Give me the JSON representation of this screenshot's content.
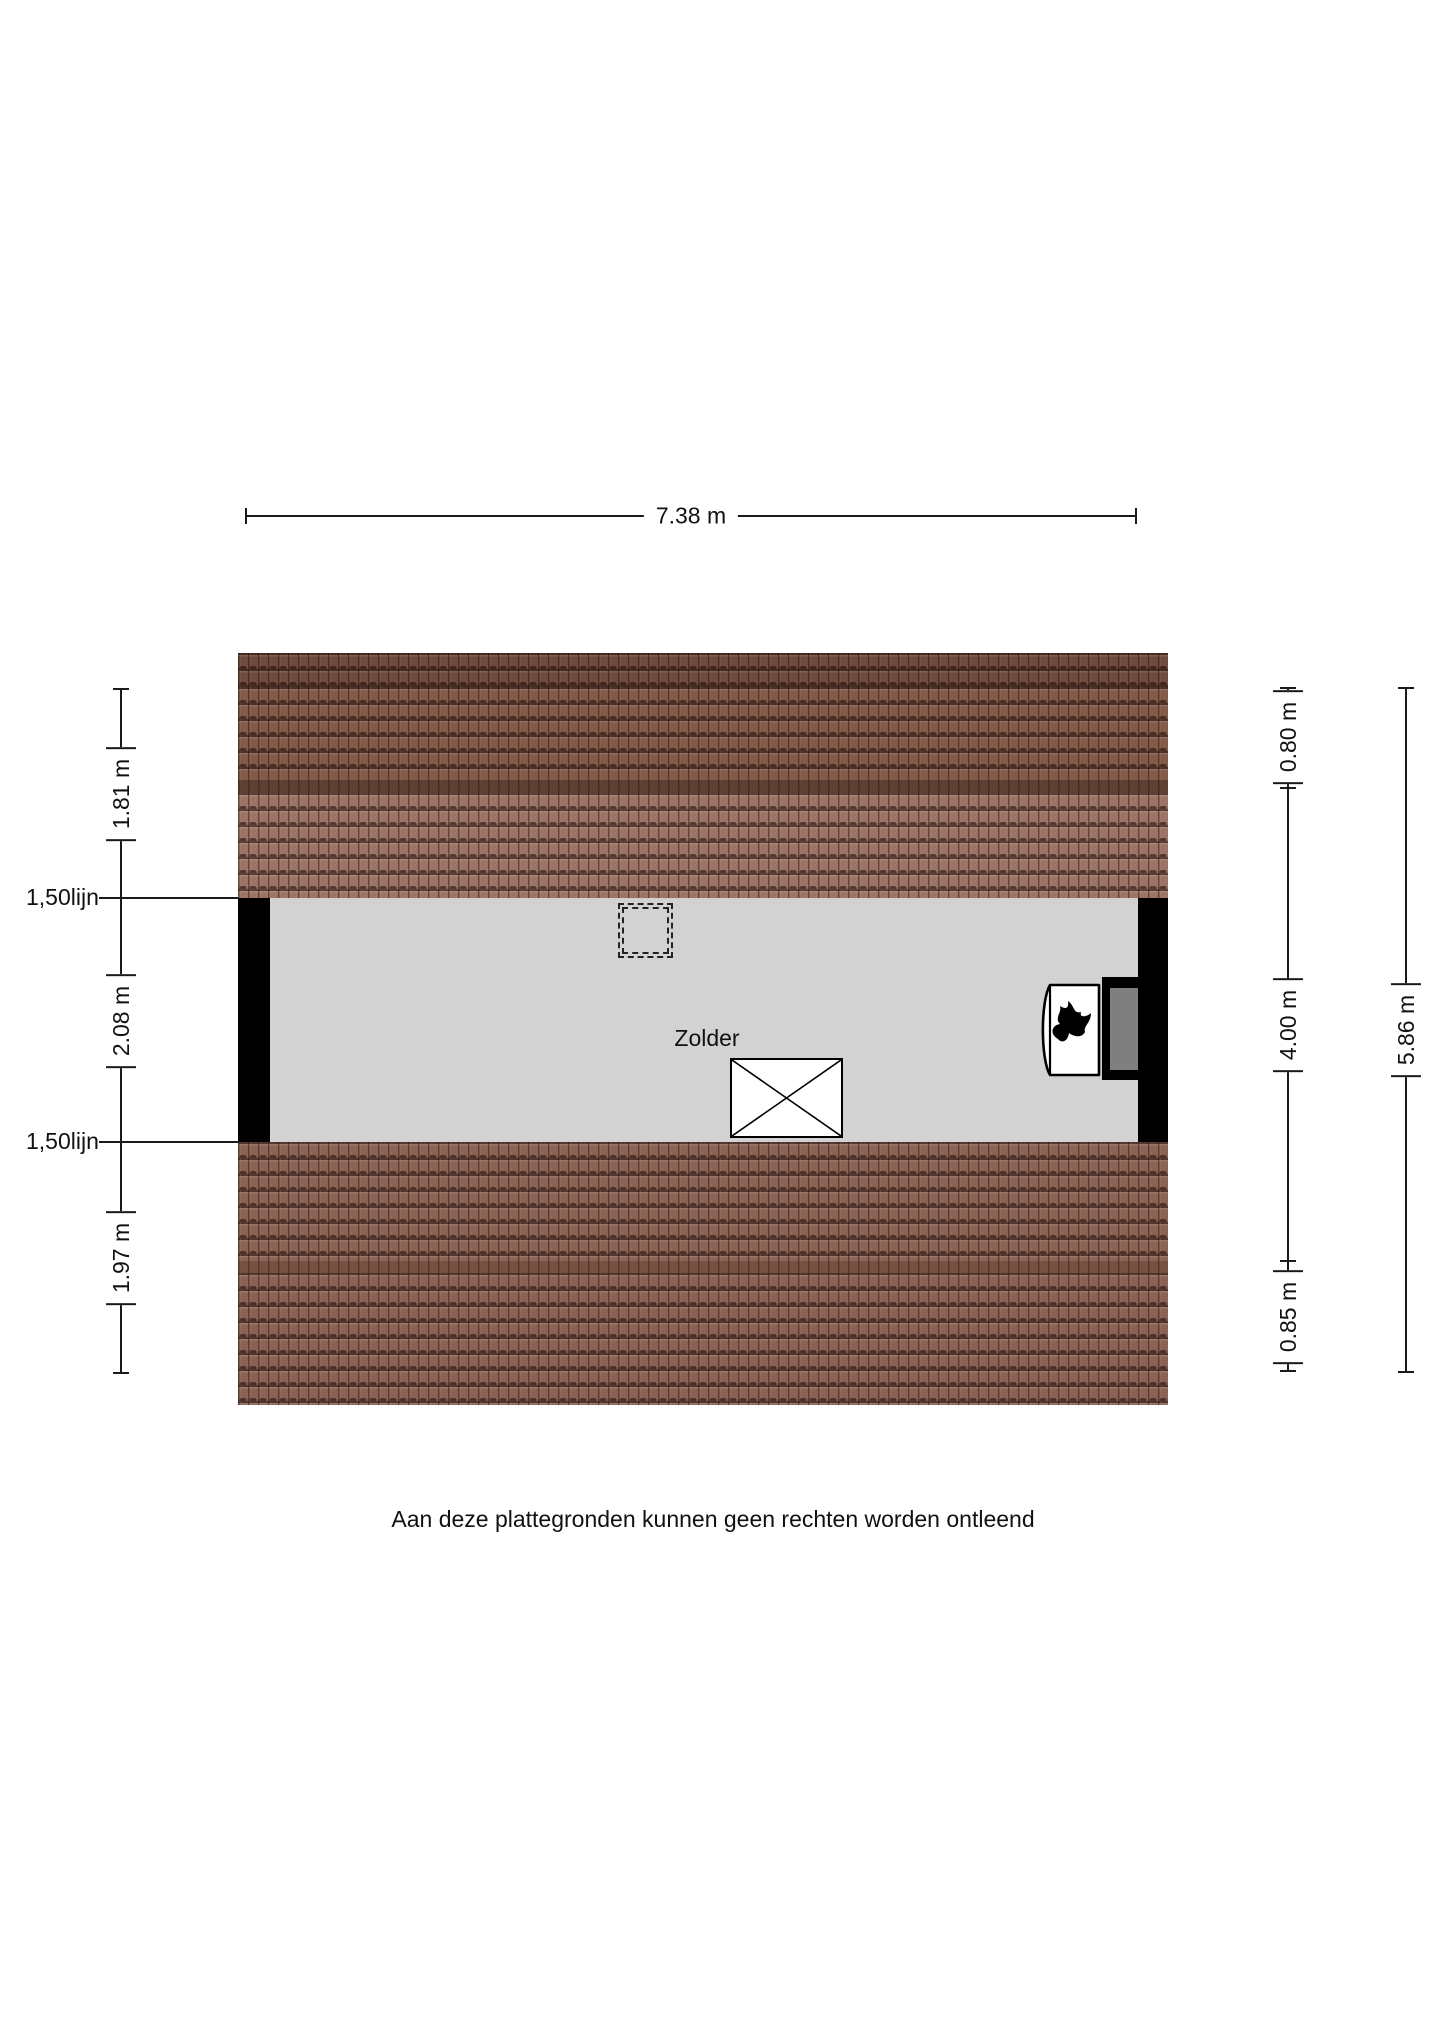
{
  "page": {
    "disclaimer": "Aan deze plattegronden kunnen geen rechten worden ontleend"
  },
  "plan": {
    "room_label": "Zolder",
    "icons": {
      "stove": "flame-icon",
      "stairs": "stairs-cross-icon",
      "chimney": "dashed-chimney-outline"
    },
    "colors": {
      "floor": "#d2d2d2",
      "wall": "#000000",
      "roof_ridge_dark": "#6f4a3d",
      "roof_mid": "#845948",
      "roof_stripe_top": "#5e4033",
      "roof_light": "#9c7364",
      "roof_bottom": "#8c6254",
      "roof_stripe_bottom": "#775042",
      "hearth_inner": "#7f7f7f",
      "stove_body": "#ffffff"
    }
  },
  "dimensions": {
    "top_width": {
      "label": "7.38 m"
    },
    "left": [
      {
        "label": "1.81 m"
      },
      {
        "label": "2.08 m"
      },
      {
        "label": "1.97 m"
      }
    ],
    "left_lines": [
      {
        "label": "1,50lijn"
      },
      {
        "label": "1,50lijn"
      }
    ],
    "right": [
      {
        "label": "0.80 m"
      },
      {
        "label": "4.00 m"
      },
      {
        "label": "0.85 m"
      }
    ],
    "right_total": {
      "label": "5.86 m"
    }
  }
}
